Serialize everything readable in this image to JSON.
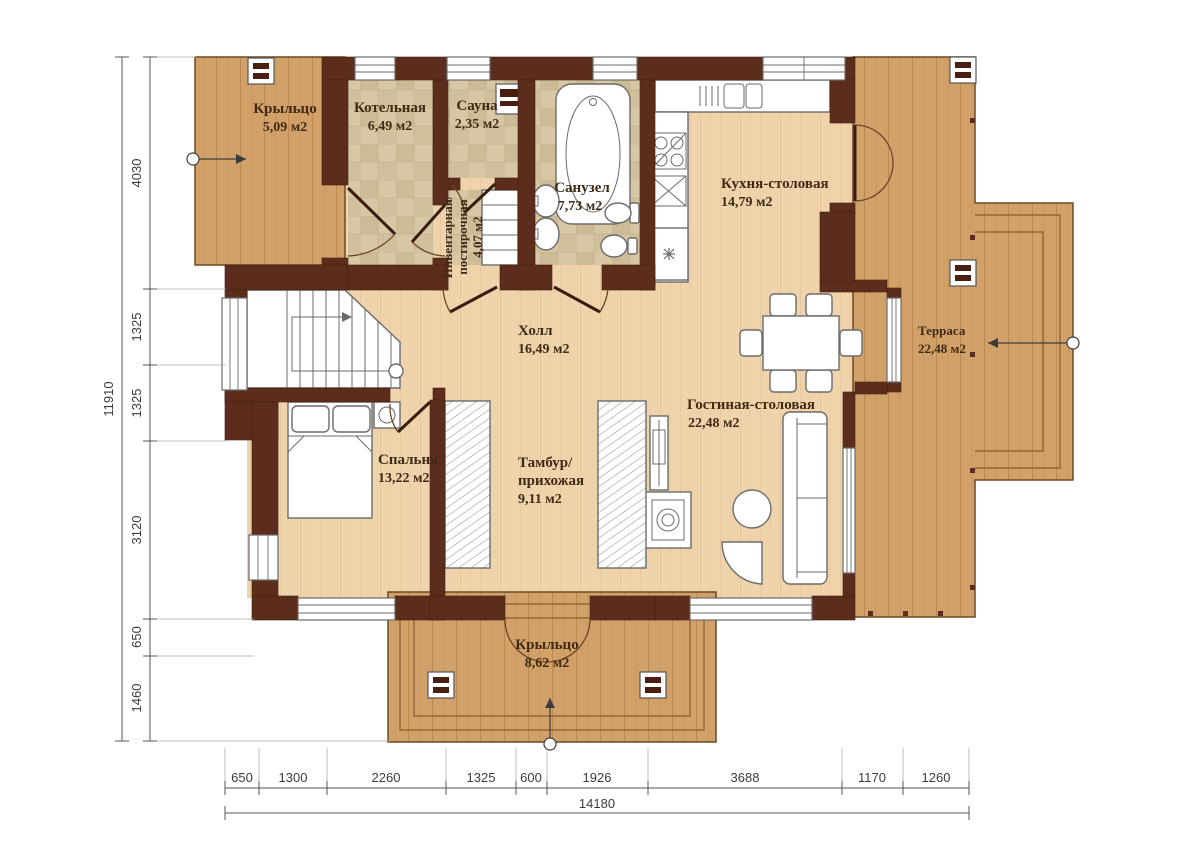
{
  "plan": {
    "rooms": [
      {
        "id": "porch-top",
        "lines": [
          "Крыльцо"
        ],
        "area": "5,09 м2"
      },
      {
        "id": "boiler-room",
        "lines": [
          "Котельная"
        ],
        "area": "6,49 м2"
      },
      {
        "id": "sauna",
        "lines": [
          "Сауна"
        ],
        "area": "2,35 м2"
      },
      {
        "id": "storage-laundry",
        "lines": [
          "Инвентарная/",
          "постирочная"
        ],
        "area": "4,07 м2"
      },
      {
        "id": "bathroom",
        "lines": [
          "Санузел"
        ],
        "area": "7,73 м2"
      },
      {
        "id": "kitchen-dining",
        "lines": [
          "Кухня-столовая"
        ],
        "area": "14,79 м2"
      },
      {
        "id": "terrace",
        "lines": [
          "Терраса"
        ],
        "area": "22,48 м2"
      },
      {
        "id": "hall",
        "lines": [
          "Холл"
        ],
        "area": "16,49 м2"
      },
      {
        "id": "living-dining",
        "lines": [
          "Гостиная-столовая"
        ],
        "area": "22,48 м2"
      },
      {
        "id": "bedroom",
        "lines": [
          "Спальня"
        ],
        "area": "13,22 м2"
      },
      {
        "id": "vestibule",
        "lines": [
          "Тамбур/",
          "прихожая"
        ],
        "area": "9,11 м2"
      },
      {
        "id": "porch-bottom",
        "lines": [
          "Крыльцо"
        ],
        "area": "8,62 м2"
      }
    ],
    "dimensions": {
      "left": {
        "segments": [
          "4030",
          "1325",
          "1325",
          "3120",
          "650",
          "1460"
        ],
        "total": "11910"
      },
      "bottom": {
        "segments": [
          "650",
          "1300",
          "2260",
          "1325",
          "600",
          "1926",
          "3688",
          "1170",
          "1260"
        ],
        "total": "14180"
      }
    },
    "colors": {
      "wall": "#5c2d1d",
      "floor": "#eed3ab",
      "porch_wood": "#d2a169",
      "tile": "#d8c7a5"
    }
  }
}
